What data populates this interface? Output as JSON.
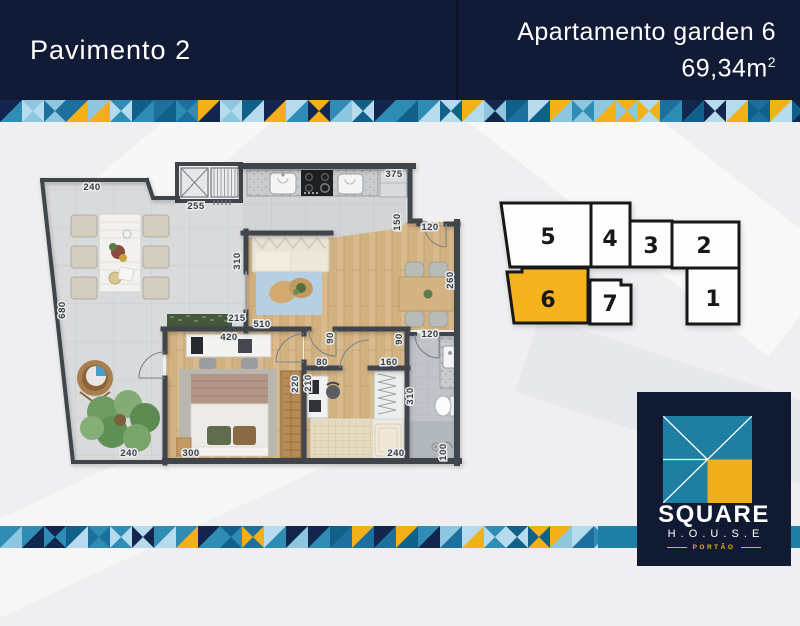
{
  "header": {
    "left_title": "Pavimento 2",
    "right_title": "Apartamento garden 6",
    "area": "69,34m",
    "area_sup": "2"
  },
  "colors": {
    "navy": "#121b36",
    "yellow": "#f2b019",
    "teal": "#1d7fa3",
    "highlight_unit": "#f4b31c",
    "mosaic_palette": [
      "#14254e",
      "#1d6f9e",
      "#2e8cb5",
      "#8ec6e0",
      "#b5dbec",
      "#f2b019",
      "#10608a"
    ]
  },
  "floorplan": {
    "dimensions": [
      {
        "t": "240",
        "x": 92,
        "y": 190,
        "r": 0
      },
      {
        "t": "255",
        "x": 196,
        "y": 209,
        "r": 0
      },
      {
        "t": "375",
        "x": 394,
        "y": 177,
        "r": 0
      },
      {
        "t": "150",
        "x": 400,
        "y": 222,
        "r": -90
      },
      {
        "t": "120",
        "x": 430,
        "y": 230,
        "r": 0
      },
      {
        "t": "260",
        "x": 453,
        "y": 280,
        "r": -90
      },
      {
        "t": "310",
        "x": 240,
        "y": 261,
        "r": -90
      },
      {
        "t": "215",
        "x": 237,
        "y": 321,
        "r": 0
      },
      {
        "t": "510",
        "x": 262,
        "y": 327,
        "r": 0
      },
      {
        "t": "90",
        "x": 333,
        "y": 338,
        "r": -90
      },
      {
        "t": "90",
        "x": 402,
        "y": 339,
        "r": -90
      },
      {
        "t": "420",
        "x": 229,
        "y": 340,
        "r": 0
      },
      {
        "t": "80",
        "x": 322,
        "y": 365,
        "r": 0
      },
      {
        "t": "160",
        "x": 389,
        "y": 365,
        "r": 0
      },
      {
        "t": "210",
        "x": 311,
        "y": 383,
        "r": -90
      },
      {
        "t": "220",
        "x": 298,
        "y": 384,
        "r": -90
      },
      {
        "t": "120",
        "x": 430,
        "y": 337,
        "r": 0
      },
      {
        "t": "310",
        "x": 413,
        "y": 396,
        "r": -90
      },
      {
        "t": "100",
        "x": 446,
        "y": 452,
        "r": -90
      },
      {
        "t": "240",
        "x": 396,
        "y": 456,
        "r": 0
      },
      {
        "t": "300",
        "x": 191,
        "y": 456,
        "r": 0
      },
      {
        "t": "240",
        "x": 129,
        "y": 456,
        "r": 0
      },
      {
        "t": "680",
        "x": 65,
        "y": 310,
        "r": -90
      }
    ]
  },
  "keyplan": {
    "highlighted_unit": "6",
    "units": [
      {
        "label": "5",
        "cx": 548,
        "cy": 244
      },
      {
        "label": "4",
        "cx": 610,
        "cy": 246
      },
      {
        "label": "3",
        "cx": 651,
        "cy": 253
      },
      {
        "label": "2",
        "cx": 704,
        "cy": 253
      },
      {
        "label": "6",
        "cx": 548,
        "cy": 307
      },
      {
        "label": "7",
        "cx": 610,
        "cy": 311
      },
      {
        "label": "1",
        "cx": 713,
        "cy": 306
      }
    ]
  },
  "logo": {
    "brand": "SQUARE",
    "house": "H . O . U . S . E",
    "tagline": "PORTÃO"
  }
}
